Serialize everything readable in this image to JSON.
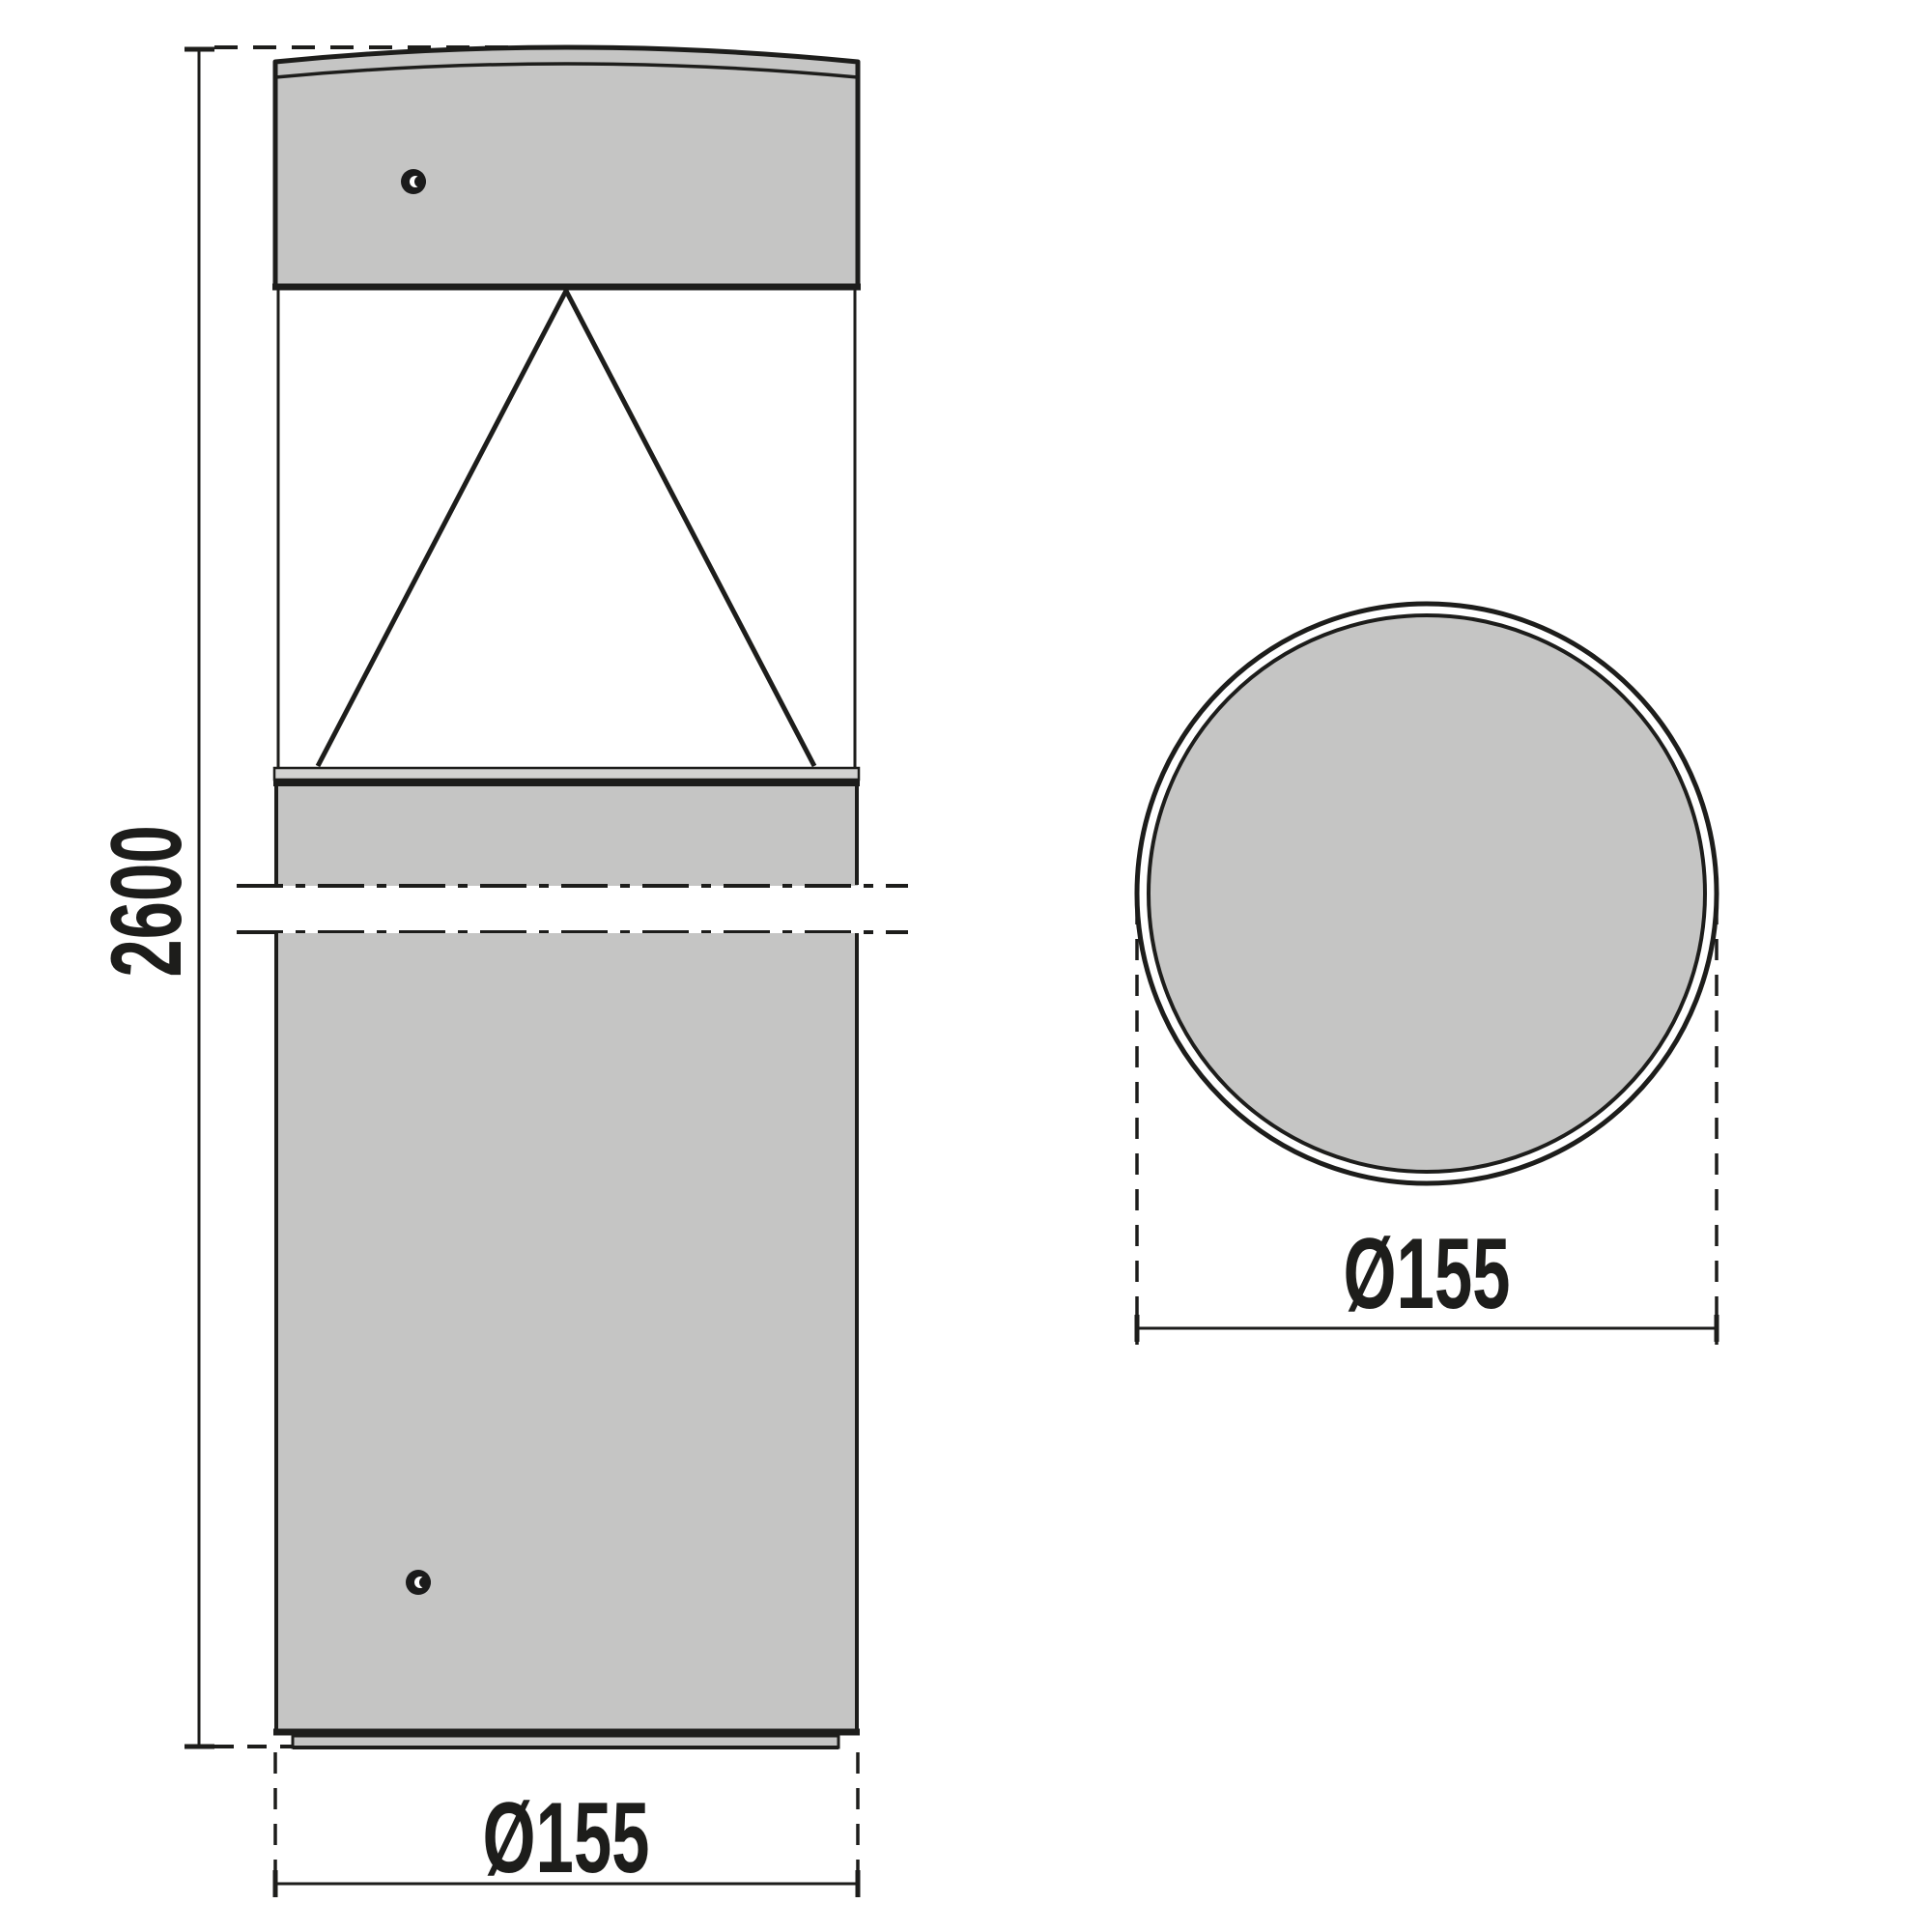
{
  "front_view": {
    "height_label": "2600",
    "diameter_label": "Ø155"
  },
  "top_view": {
    "diameter_label": "Ø155"
  },
  "colors": {
    "surface_gray": "#c5c5c4",
    "strip_gray": "#d2d2d1",
    "line_dark": "#1d1d1b"
  }
}
